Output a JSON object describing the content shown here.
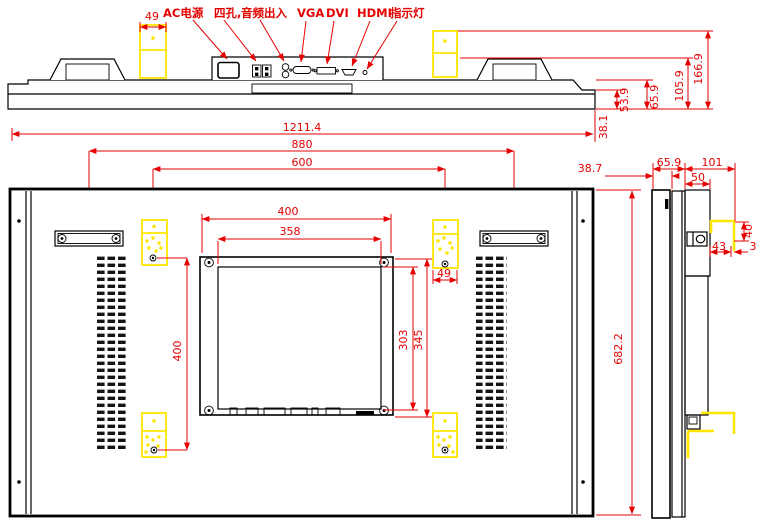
{
  "colors": {
    "dimension_red": "#e60000",
    "highlight_yellow": "#ffe600",
    "line_black": "#000000"
  },
  "top_view": {
    "bracket_width_dim": "49",
    "labels": {
      "ac_power": "AC电源",
      "four_hole": "四孔,",
      "audio_io": "音频出入",
      "vga": "VGA",
      "dvi": "DVI",
      "hdmi": "HDMI",
      "indicator": "指示灯"
    },
    "depth_dims": {
      "front_step": "53.9",
      "body": "65.9",
      "with_connector_panel": "105.9",
      "with_bracket": "166.9",
      "front": "38.1"
    }
  },
  "overall_dims": {
    "width": "1211.4",
    "handle_span": "880",
    "mount_hole_span": "600"
  },
  "rear_view": {
    "plate_width": "400",
    "plate_inner_width": "358",
    "plate_inner_height": "303",
    "plate_height": "345",
    "bracket_hole_vspan": "400",
    "bracket_width": "49",
    "height": "682.2"
  },
  "side_view": {
    "front_depth": "38.7",
    "body_depth": "65.9",
    "overall_depth": "101",
    "rail_depth": "50",
    "hook_height": "40",
    "hook_width": "43",
    "hook_gap": "3"
  }
}
